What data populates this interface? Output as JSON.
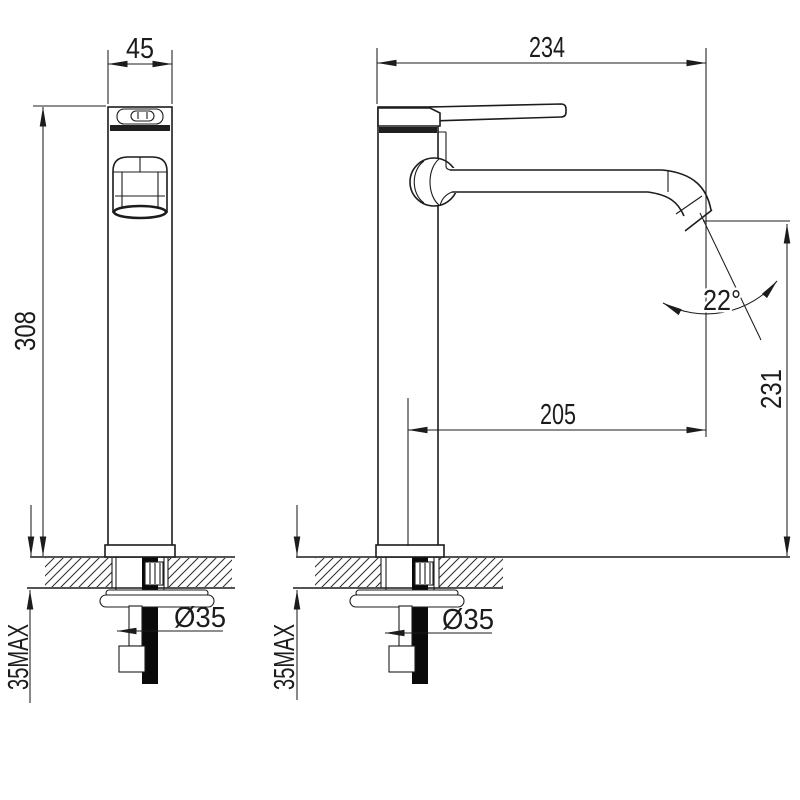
{
  "drawing": {
    "subject": "tall single-lever basin mixer tap - dimensioned front and side views",
    "units": "mm",
    "colors": {
      "line": "#1c1c1c",
      "background": "#ffffff",
      "solid_fill": "#0a0a0a"
    },
    "views": {
      "front": {
        "width_mm": "45",
        "height_mm": "308",
        "mount_hole": "Ø35",
        "deck_thickness": "35MAX"
      },
      "side": {
        "overall_length_mm": "234",
        "spout_reach_mm": "205",
        "outlet_height_mm": "231",
        "outlet_angle": "22°",
        "mount_hole": "Ø35",
        "deck_thickness": "35MAX"
      }
    }
  }
}
